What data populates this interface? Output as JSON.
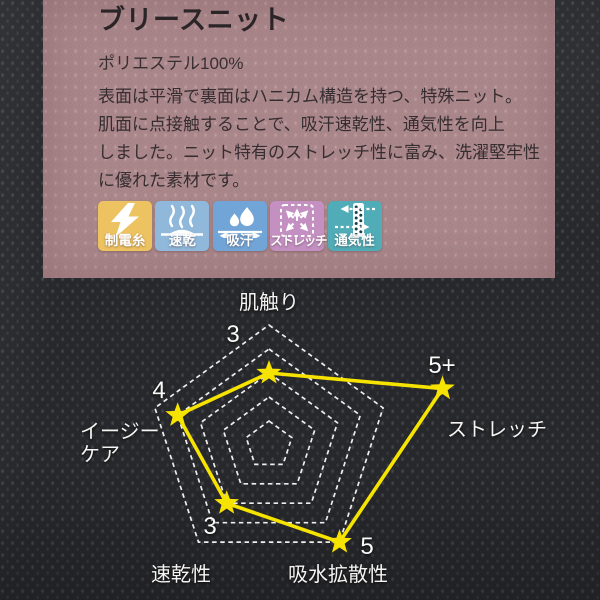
{
  "panel": {
    "title": "ブリースニット",
    "composition": "ポリエステル100%",
    "description": "表面は平滑で裏面はハニカム構造を持つ、特殊ニット。\n肌面に点接触することで、吸汗速乾性、通気性を向上\nしました。ニット特有のストレッチ性に富み、洗濯堅牢性\nに優れた素材です。",
    "background_color": "#ab888c"
  },
  "features": [
    {
      "label": "制電糸",
      "icon": "lightning-icon",
      "color": "#edc261"
    },
    {
      "label": "速乾",
      "icon": "steam-icon",
      "color": "#8fb8da"
    },
    {
      "label": "吸汗",
      "icon": "water-drops-icon",
      "color": "#72a5d7"
    },
    {
      "label": "ストレッチ",
      "icon": "stretch-arrows-icon",
      "color": "#c390c1"
    },
    {
      "label": "通気性",
      "icon": "airflow-icon",
      "color": "#50acb6"
    }
  ],
  "chart_data": {
    "type": "radar",
    "title": "",
    "axes": [
      "肌触り",
      "ストレッチ",
      "吸水拡散性",
      "速乾性",
      "イージーケア"
    ],
    "axis_display": [
      "肌触り",
      "ストレッチ",
      "吸水拡散性",
      "速乾性",
      "イージー\nケア"
    ],
    "values": [
      3,
      5,
      5,
      3,
      4
    ],
    "value_labels": [
      "3",
      "5+",
      "5",
      "3",
      "4"
    ],
    "plot_levels": [
      3,
      7.6,
      5,
      3,
      4
    ],
    "levels": 5,
    "marker": "star",
    "series_color": "#f6e300",
    "ring_color": "#ffffff",
    "legend": false,
    "grid": "nested-dashed-pentagons"
  }
}
